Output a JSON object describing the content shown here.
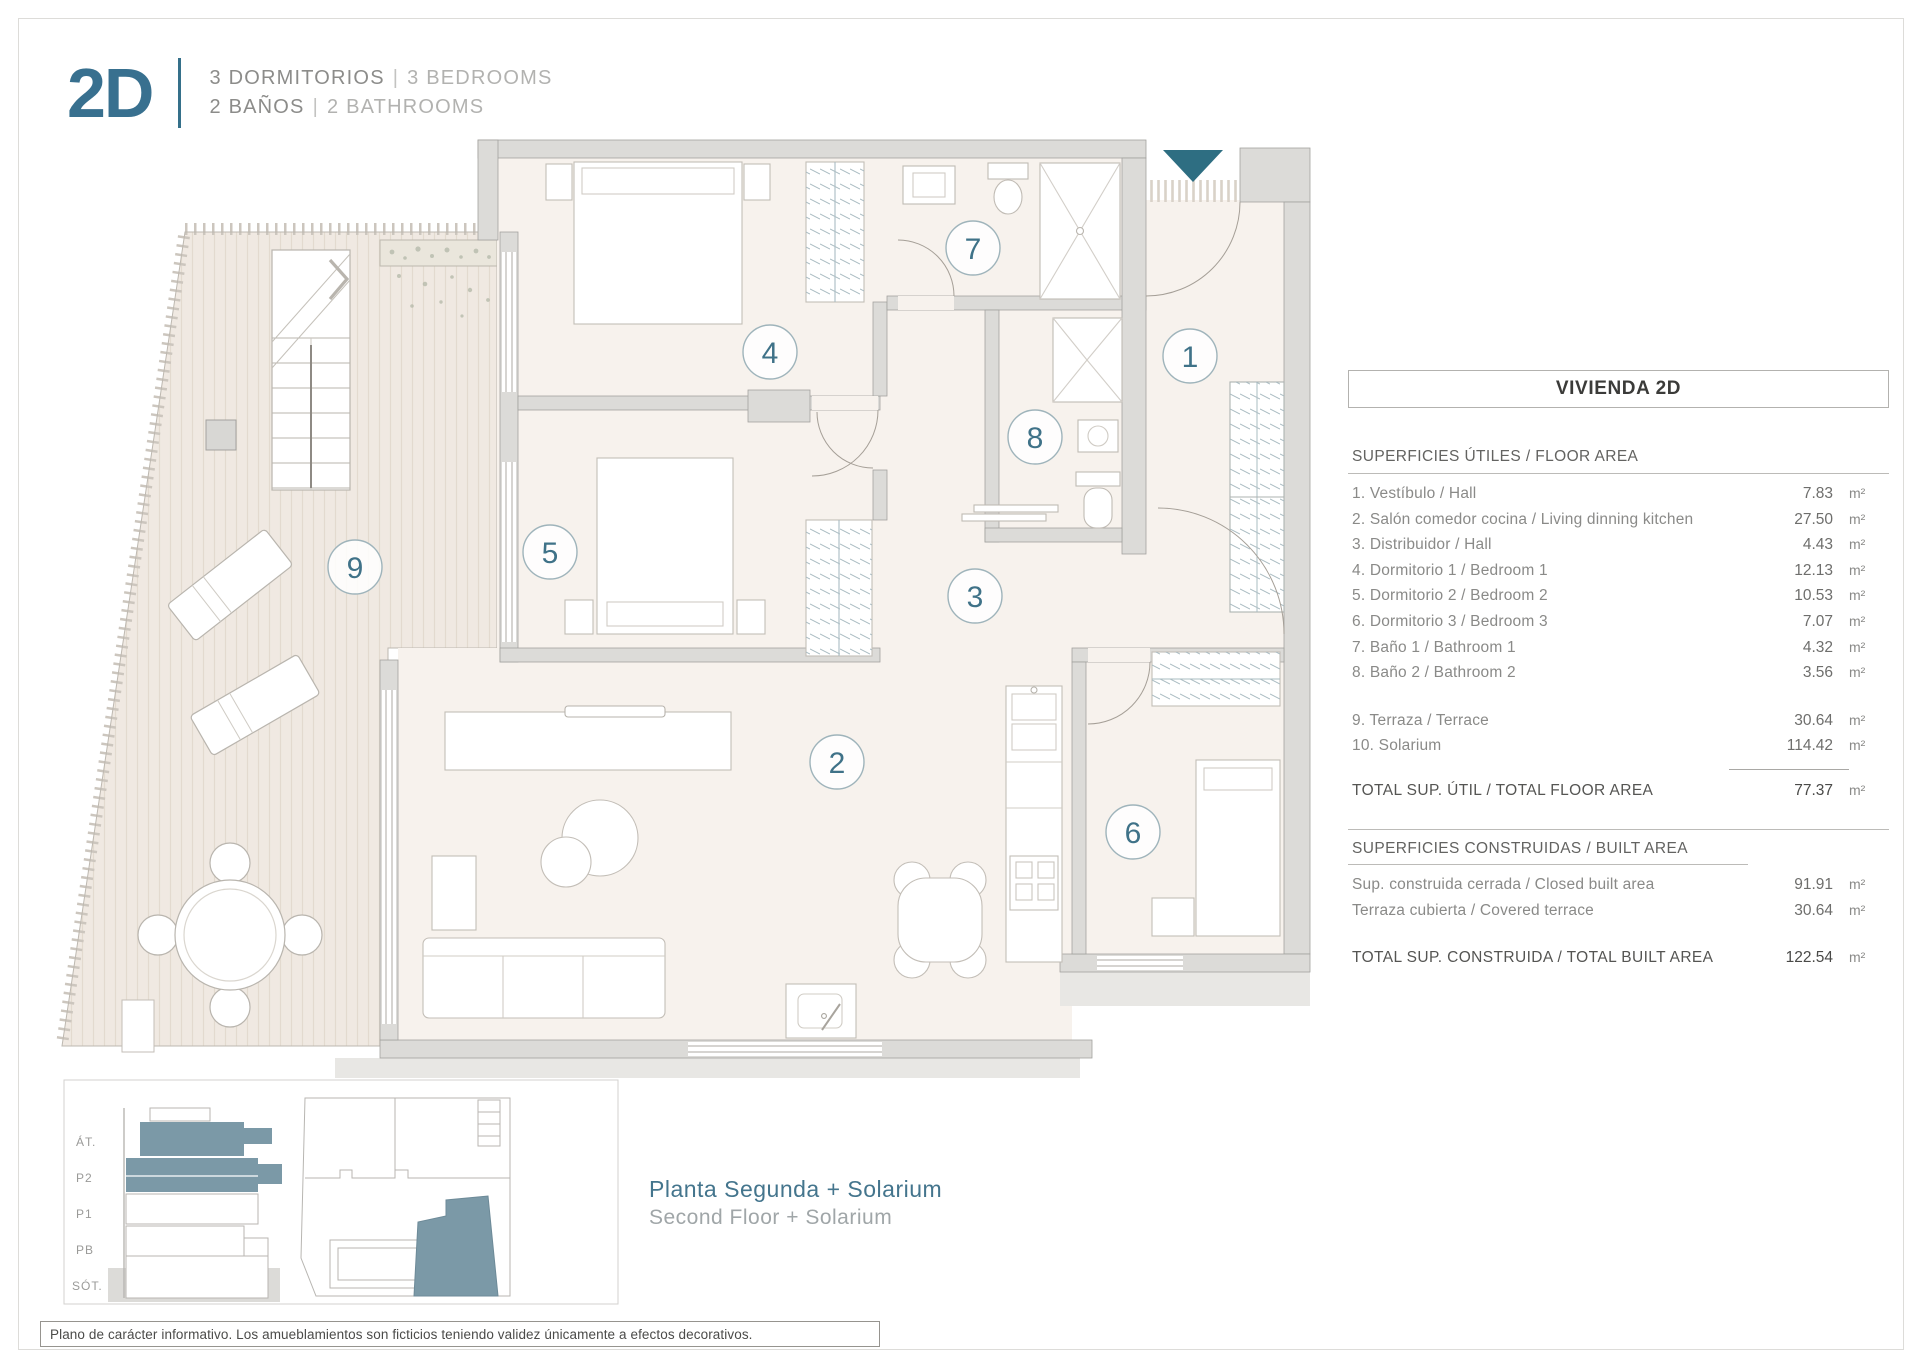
{
  "header": {
    "logo": "2D",
    "line1_primary": "3 DORMITORIOS",
    "line1_sep": "|",
    "line1_secondary": "3 BEDROOMS",
    "line2_primary": "2 BAÑOS",
    "line2_sep": "|",
    "line2_secondary": "2 BATHROOMS"
  },
  "panel": {
    "title": "VIVIENDA 2D",
    "unit": "m²",
    "floor_area": {
      "section": "SUPERFICIES ÚTILES / FLOOR AREA",
      "rows": [
        {
          "label": "1. Vestíbulo / Hall",
          "value": "7.83"
        },
        {
          "label": "2. Salón comedor cocina / Living dinning kitchen",
          "value": "27.50"
        },
        {
          "label": "3. Distribuidor / Hall",
          "value": "4.43"
        },
        {
          "label": "4. Dormitorio 1 / Bedroom 1",
          "value": "12.13"
        },
        {
          "label": "5. Dormitorio 2 / Bedroom 2",
          "value": "10.53"
        },
        {
          "label": "6. Dormitorio 3 / Bedroom 3",
          "value": "7.07"
        },
        {
          "label": "7. Baño 1 / Bathroom 1",
          "value": "4.32"
        },
        {
          "label": "8. Baño 2 / Bathroom 2",
          "value": "3.56"
        }
      ],
      "extra_rows": [
        {
          "label": "9. Terraza / Terrace",
          "value": "30.64"
        },
        {
          "label": "10. Solarium",
          "value": "114.42"
        }
      ],
      "total_label": "TOTAL SUP. ÚTIL / TOTAL FLOOR AREA",
      "total_value": "77.37"
    },
    "built_area": {
      "section": "SUPERFICIES CONSTRUIDAS / BUILT AREA",
      "rows": [
        {
          "label": "Sup. construida cerrada / Closed built area",
          "value": "91.91"
        },
        {
          "label": "Terraza cubierta / Covered terrace",
          "value": "30.64"
        }
      ],
      "total_label": "TOTAL SUP. CONSTRUIDA /  TOTAL BUILT AREA",
      "total_value": "122.54"
    }
  },
  "plan": {
    "rooms": [
      "1",
      "2",
      "3",
      "4",
      "5",
      "6",
      "7",
      "8",
      "9"
    ]
  },
  "legend": {
    "floors": [
      "ÁT.",
      "P2",
      "P1",
      "PB",
      "SÓT."
    ],
    "title_es": "Planta Segunda + Solarium",
    "title_en": "Second Floor + Solarium"
  },
  "footer": {
    "disclaimer": "Plano de carácter informativo. Los amueblamientos son ficticios teniendo validez únicamente a efectos decorativos."
  },
  "colors": {
    "accent": "#2e6e82",
    "accent_soft": "#7b99a7"
  }
}
